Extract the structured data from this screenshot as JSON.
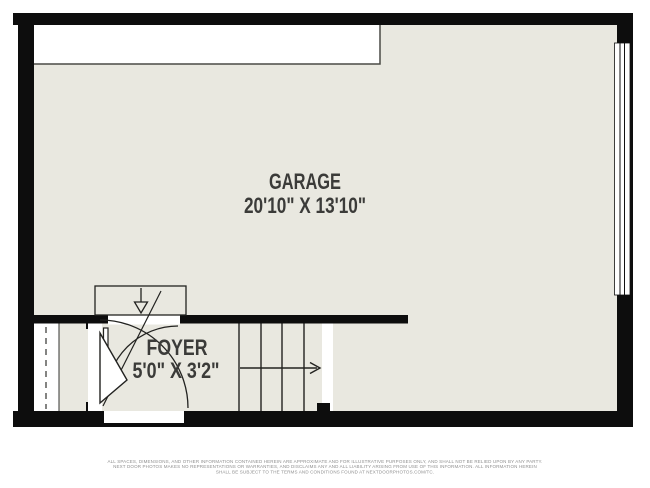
{
  "floor_plan": {
    "rooms": [
      {
        "name": "GARAGE",
        "dimensions": "20'10\" X 13'10\""
      },
      {
        "name": "FOYER",
        "dimensions": "5'0\" X 3'2\""
      }
    ],
    "symbols": {
      "entry_arrow_top": "down-arrow",
      "stair_arrow": "right-arrow",
      "window_right": "triple-line-window",
      "opening_left": "dashed-opening"
    },
    "disclaimer_lines": [
      "ALL SPACES, DIMENSIONS, AND OTHER INFORMATION CONTAINED HEREIN ARE APPROXIMATE AND FOR ILLUSTRATIVE PURPOSES ONLY, AND SHALL NOT BE RELIED UPON BY ANY PARTY.",
      "NEXT DOOR PHOTOS MAKES NO REPRESENTATIONS OR WARRANTIES, AND DISCLAIMS ANY AND ALL LIABILITY ARISING FROM USE OF THIS INFORMATION. ALL INFORMATION HEREIN",
      "SHALL BE SUBJECT TO THE TERMS AND CONDITIONS FOUND AT NEXTDOORPHOTOS.COM/TC."
    ],
    "colors": {
      "floor": "#e9e8e0",
      "wall": "#0d0d0d",
      "label_text": "#3b3b39",
      "disclaimer_text": "#8f8f8f"
    }
  }
}
